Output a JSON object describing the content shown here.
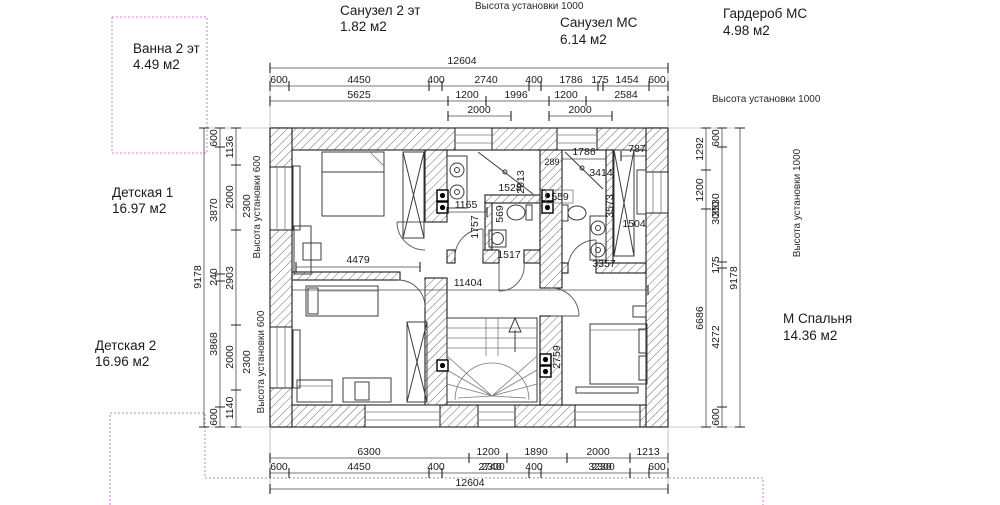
{
  "rooms": {
    "bath2": {
      "name": "Ванна 2 эт",
      "area": "4.49 м2"
    },
    "wc2": {
      "name": "Санузел 2 эт",
      "area": "1.82 м2"
    },
    "wc_ms": {
      "name": "Санузел МС",
      "area": "6.14 м2"
    },
    "wardrobe_ms": {
      "name": "Гардероб МС",
      "area": "4.98 м2"
    },
    "kids1": {
      "name": "Детская 1",
      "area": "16.97 м2"
    },
    "kids2": {
      "name": "Детская 2",
      "area": "16.96 м2"
    },
    "master": {
      "name": "М Спальня",
      "area": "14.36 м2"
    }
  },
  "notes": {
    "install_height_1000": "Высота установки 1000",
    "install_height_600": "Высота установки 600"
  },
  "dims": {
    "top": {
      "total": "12604",
      "row2": [
        "600",
        "4450",
        "400",
        "2740",
        "400",
        "1786",
        "175",
        "1454",
        "600"
      ],
      "row3": [
        "5625",
        "1200",
        "1996",
        "1200",
        "2584"
      ],
      "row4": [
        "2000",
        "2000"
      ]
    },
    "bottom": {
      "row1": [
        "6300",
        "1200",
        "1890",
        "2000",
        "1213"
      ],
      "row2": [
        "600",
        "4450",
        "400",
        "2740",
        "400",
        "3230",
        "600"
      ],
      "row2_overlap": [
        "2300",
        "2300"
      ],
      "total": "12604"
    },
    "left": {
      "total": "9178",
      "chain_outer": [
        "600",
        "3870",
        "240",
        "3868",
        "600"
      ],
      "chain_inner": [
        "1136",
        "2000",
        "2903",
        "2000",
        "1140"
      ],
      "extra": [
        "2300",
        "2300"
      ]
    },
    "right": {
      "total": "9178",
      "chain_inner": [
        "1292",
        "1200",
        "6686"
      ],
      "chain_outer": [
        "600",
        "3530",
        "175",
        "4272",
        "600"
      ],
      "extra": [
        "3000"
      ]
    },
    "interior": {
      "kids1_width": "4479",
      "corridor_width": "11404",
      "bath_width": "1165",
      "wc_width": "1528",
      "wc_depth": "2013",
      "bath_depth": "1757",
      "wc_inner": "569",
      "ms_toilet": "559",
      "wc_bottom": "1517",
      "ms_top": "1786",
      "ms_corner": "289",
      "ms_diag": "3414",
      "wardrobe_width": "787",
      "ms_depth": "3573",
      "wardrobe_depth": "1504",
      "ms_bottom": "3357",
      "master_door": "2759"
    }
  }
}
